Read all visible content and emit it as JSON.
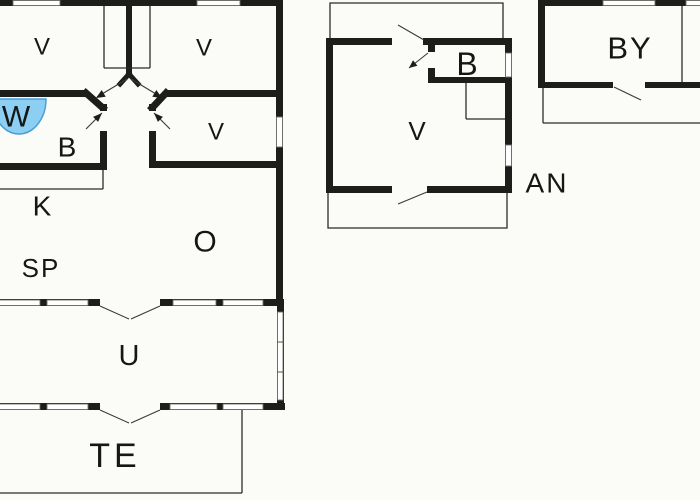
{
  "plan": {
    "kind": "holiday-house-floor-plan",
    "buildings": [
      {
        "id": "main-house"
      },
      {
        "id": "annex"
      },
      {
        "id": "outbuilding"
      }
    ]
  },
  "rooms": [
    {
      "id": "bedroom-top-left",
      "label": "V"
    },
    {
      "id": "bedroom-top-right",
      "label": "V"
    },
    {
      "id": "wc",
      "label": "W"
    },
    {
      "id": "bathroom",
      "label": "B"
    },
    {
      "id": "bedroom-mid-right",
      "label": "V"
    },
    {
      "id": "kitchen",
      "label": "K"
    },
    {
      "id": "dining",
      "label": "SP"
    },
    {
      "id": "living-room",
      "label": "O"
    },
    {
      "id": "conservatory",
      "label": "U"
    },
    {
      "id": "terrace",
      "label": "TE"
    },
    {
      "id": "annex-room",
      "label": "V"
    },
    {
      "id": "annex-bath",
      "label": "B"
    },
    {
      "id": "annex-tag",
      "label": "AN"
    },
    {
      "id": "outbuilding-room",
      "label": "BY"
    }
  ],
  "colors": {
    "wall": "#1d1d1b",
    "background": "#fbfbf8",
    "fixture_fill": "#8CCFF3",
    "fixture_stroke": "#47A0D5"
  }
}
